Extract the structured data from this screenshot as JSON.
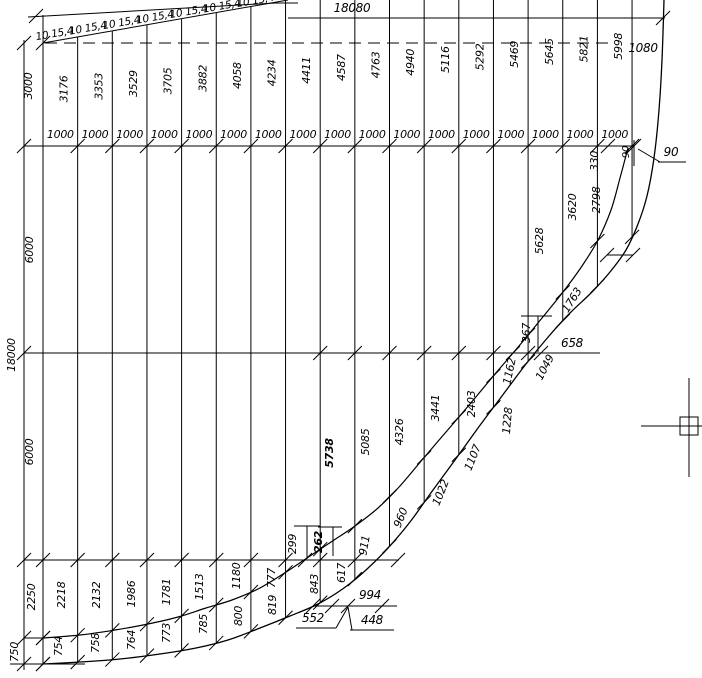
{
  "drawing": {
    "colors": {
      "background": "#ffffff",
      "line": "#000000"
    },
    "top_dimension_label": "18080",
    "deck_plate_label": "10 15,4",
    "deck_plate_repeat": 7,
    "spacing_label": "1000",
    "spacing_count": 17,
    "top_right_segment_label": "1080",
    "left_chain": {
      "total": "18000",
      "segments": [
        "3000",
        "6000",
        "6000",
        "2250",
        "750"
      ]
    },
    "station_heights": [
      "3176",
      "3353",
      "3529",
      "3705",
      "3882",
      "4058",
      "4234",
      "4411",
      "4587",
      "4763",
      "4940",
      "5116",
      "5292",
      "5469",
      "5645",
      "5821",
      "5998"
    ],
    "annotations": [
      {
        "t": "18080",
        "x": 352,
        "y": 12,
        "r": 0,
        "fs": 12
      },
      {
        "t": "1080",
        "x": 643,
        "y": 52,
        "r": 0,
        "fs": 12
      },
      {
        "t": "3000",
        "x": 32,
        "y": 86,
        "r": -90
      },
      {
        "t": "6000",
        "x": 33,
        "y": 250,
        "r": -90
      },
      {
        "t": "18000",
        "x": 15,
        "y": 355,
        "r": -90
      },
      {
        "t": "6000",
        "x": 33,
        "y": 452,
        "r": -90
      },
      {
        "t": "2250",
        "x": 35,
        "y": 597,
        "r": -90
      },
      {
        "t": "750",
        "x": 18,
        "y": 652,
        "r": -90
      },
      {
        "t": "2218",
        "x": 65,
        "y": 595,
        "r": -90
      },
      {
        "t": "2132",
        "x": 100,
        "y": 595,
        "r": -90
      },
      {
        "t": "1986",
        "x": 135,
        "y": 594,
        "r": -90
      },
      {
        "t": "1781",
        "x": 170,
        "y": 592,
        "r": -90
      },
      {
        "t": "1513",
        "x": 203,
        "y": 587,
        "r": -90
      },
      {
        "t": "1180",
        "x": 240,
        "y": 576,
        "r": -90
      },
      {
        "t": "777",
        "x": 275,
        "y": 578,
        "r": -90
      },
      {
        "t": "299",
        "x": 296,
        "y": 544,
        "r": -90
      },
      {
        "t": "262",
        "x": 322,
        "y": 542,
        "r": -90,
        "b": true
      },
      {
        "t": "754",
        "x": 62,
        "y": 646,
        "r": -90
      },
      {
        "t": "758",
        "x": 99,
        "y": 643,
        "r": -90
      },
      {
        "t": "764",
        "x": 135,
        "y": 640,
        "r": -90
      },
      {
        "t": "773",
        "x": 170,
        "y": 633,
        "r": -90
      },
      {
        "t": "785",
        "x": 207,
        "y": 624,
        "r": -90
      },
      {
        "t": "800",
        "x": 242,
        "y": 616,
        "r": -90
      },
      {
        "t": "819",
        "x": 276,
        "y": 605,
        "r": -90
      },
      {
        "t": "843",
        "x": 318,
        "y": 584,
        "r": -90
      },
      {
        "t": "617",
        "x": 345,
        "y": 573,
        "r": -90
      },
      {
        "t": "911",
        "x": 368,
        "y": 546,
        "r": -80
      },
      {
        "t": "960",
        "x": 404,
        "y": 519,
        "r": -68
      },
      {
        "t": "1022",
        "x": 444,
        "y": 494,
        "r": -68
      },
      {
        "t": "1107",
        "x": 476,
        "y": 459,
        "r": -68
      },
      {
        "t": "552",
        "x": 313,
        "y": 622,
        "r": 0,
        "fs": 12
      },
      {
        "t": "448",
        "x": 372,
        "y": 624,
        "r": 0,
        "fs": 12
      },
      {
        "t": "994",
        "x": 370,
        "y": 599,
        "r": 0,
        "fs": 12
      },
      {
        "t": "5738",
        "x": 333,
        "y": 453,
        "r": -90,
        "b": true
      },
      {
        "t": "5085",
        "x": 369,
        "y": 442,
        "r": -90
      },
      {
        "t": "4326",
        "x": 403,
        "y": 432,
        "r": -90
      },
      {
        "t": "3441",
        "x": 439,
        "y": 408,
        "r": -90
      },
      {
        "t": "2403",
        "x": 475,
        "y": 404,
        "r": -90
      },
      {
        "t": "1228",
        "x": 511,
        "y": 421,
        "r": -85
      },
      {
        "t": "1162",
        "x": 513,
        "y": 372,
        "r": -78
      },
      {
        "t": "1049",
        "x": 548,
        "y": 369,
        "r": -62
      },
      {
        "t": "367",
        "x": 530,
        "y": 333,
        "r": -90
      },
      {
        "t": "658",
        "x": 572,
        "y": 347,
        "r": 0,
        "fs": 12
      },
      {
        "t": "1763",
        "x": 575,
        "y": 302,
        "r": -58
      },
      {
        "t": "5628",
        "x": 543,
        "y": 241,
        "r": -90
      },
      {
        "t": "3620",
        "x": 576,
        "y": 207,
        "r": -90
      },
      {
        "t": "2798",
        "x": 600,
        "y": 200,
        "r": -90
      },
      {
        "t": "330",
        "x": 598,
        "y": 161,
        "r": -90
      },
      {
        "t": "90",
        "x": 629,
        "y": 152,
        "r": -90,
        "fs": 10
      },
      {
        "t": "90",
        "x": 671,
        "y": 156,
        "r": 0,
        "fs": 12
      }
    ],
    "geometry": {
      "canvas": {
        "w": 702,
        "h": 678
      },
      "stations": {
        "x0": 43,
        "dx": 34.65,
        "count": 18,
        "top_slope": 0.1764
      },
      "rows": {
        "top_dim_y": 18,
        "dash_y": 43,
        "thousand_y": 146,
        "mid_y": 353,
        "low_y": 560,
        "dim994_y": 606,
        "base_y": 664
      },
      "heights_label_y_anchor": 89,
      "heights_label_slope": 0.077,
      "thousand_label_y": 138,
      "plate_labels": {
        "x_start": 55,
        "dx": 33.5,
        "y_start": 37,
        "slope": 0.165,
        "rot": -10
      },
      "curves": {
        "outer": [
          [
            664,
            0
          ],
          [
            662,
            60
          ],
          [
            659,
            110
          ],
          [
            654,
            158
          ],
          [
            647,
            196
          ],
          [
            638,
            224
          ],
          [
            626,
            250
          ],
          [
            610,
            272
          ],
          [
            592,
            292
          ],
          [
            571,
            312
          ],
          [
            549,
            336
          ],
          [
            526,
            364
          ],
          [
            502,
            396
          ],
          [
            478,
            428
          ],
          [
            455,
            460
          ],
          [
            433,
            490
          ],
          [
            410,
            522
          ],
          [
            388,
            548
          ],
          [
            366,
            570
          ],
          [
            344,
            588
          ],
          [
            318,
            604
          ],
          [
            290,
            616
          ],
          [
            260,
            628
          ],
          [
            228,
            640
          ],
          [
            196,
            648
          ],
          [
            160,
            654
          ],
          [
            120,
            659
          ],
          [
            80,
            662
          ],
          [
            43,
            664
          ]
        ],
        "inner": [
          [
            628,
            148
          ],
          [
            620,
            178
          ],
          [
            611,
            210
          ],
          [
            598,
            240
          ],
          [
            582,
            266
          ],
          [
            563,
            292
          ],
          [
            542,
            318
          ],
          [
            519,
            346
          ],
          [
            495,
            374
          ],
          [
            470,
            404
          ],
          [
            446,
            432
          ],
          [
            422,
            460
          ],
          [
            400,
            486
          ],
          [
            378,
            508
          ],
          [
            355,
            526
          ],
          [
            331,
            542
          ],
          [
            307,
            558
          ],
          [
            283,
            574
          ],
          [
            258,
            589
          ],
          [
            232,
            600
          ],
          [
            206,
            608
          ],
          [
            178,
            617
          ],
          [
            148,
            624
          ],
          [
            115,
            630
          ],
          [
            80,
            635
          ],
          [
            43,
            638
          ]
        ]
      },
      "solid_lines": [
        [
          43,
          15,
          43,
          43
        ],
        [
          28,
          17,
          276,
          3
        ],
        [
          43,
          43,
          288,
          0
        ],
        [
          276,
          3,
          298,
          3
        ],
        [
          288,
          18,
          665,
          18
        ],
        [
          24,
          40,
          24,
          670
        ],
        [
          24,
          146,
          634,
          146
        ],
        [
          24,
          353,
          600,
          353
        ],
        [
          24,
          560,
          399,
          560
        ],
        [
          313,
          606,
          397,
          606
        ],
        [
          24,
          638,
          43,
          638
        ],
        [
          10,
          664,
          85,
          664
        ],
        [
          607,
          255,
          633,
          255
        ],
        [
          634,
          140,
          634,
          166
        ],
        [
          538,
          316,
          538,
          352
        ],
        [
          521,
          316,
          552,
          316
        ],
        [
          307,
          526,
          307,
          559
        ],
        [
          294,
          526,
          320,
          526
        ],
        [
          333,
          527,
          333,
          556
        ],
        [
          318,
          527,
          342,
          527
        ],
        [
          296,
          628,
          336,
          628
        ],
        [
          336,
          628,
          348,
          607
        ],
        [
          350,
          630,
          394,
          630
        ],
        [
          352,
          630,
          348,
          607
        ],
        [
          658,
          162,
          686,
          162
        ],
        [
          660,
          162,
          638,
          149
        ]
      ],
      "dashed_lines": [
        [
          45,
          43,
          612,
          43
        ]
      ],
      "tick_rows": {
        "thousand": [
          1,
          17
        ],
        "mid": [
          8,
          14
        ],
        "low": [
          0,
          9
        ]
      },
      "extra_ticks": [
        [
          24,
          43
        ],
        [
          24,
          146
        ],
        [
          24,
          353
        ],
        [
          24,
          560
        ],
        [
          24,
          638
        ],
        [
          24,
          664
        ],
        [
          43,
          638
        ],
        [
          43,
          664
        ],
        [
          36,
          16
        ],
        [
          43,
          43
        ],
        [
          663,
          18
        ],
        [
          313,
          606
        ],
        [
          332,
          606
        ],
        [
          348,
          606
        ],
        [
          382,
          606
        ],
        [
          634,
          146
        ],
        [
          608,
          146
        ],
        [
          607,
          255
        ],
        [
          633,
          255
        ],
        [
          305,
          560
        ],
        [
          398,
          560
        ],
        [
          513,
          353
        ],
        [
          541,
          353
        ]
      ],
      "crosshair": {
        "cx": 689,
        "cy": 426,
        "v_top": 378,
        "v_bot": 477,
        "h_left": 641,
        "h_right": 702,
        "box": 18
      }
    }
  }
}
